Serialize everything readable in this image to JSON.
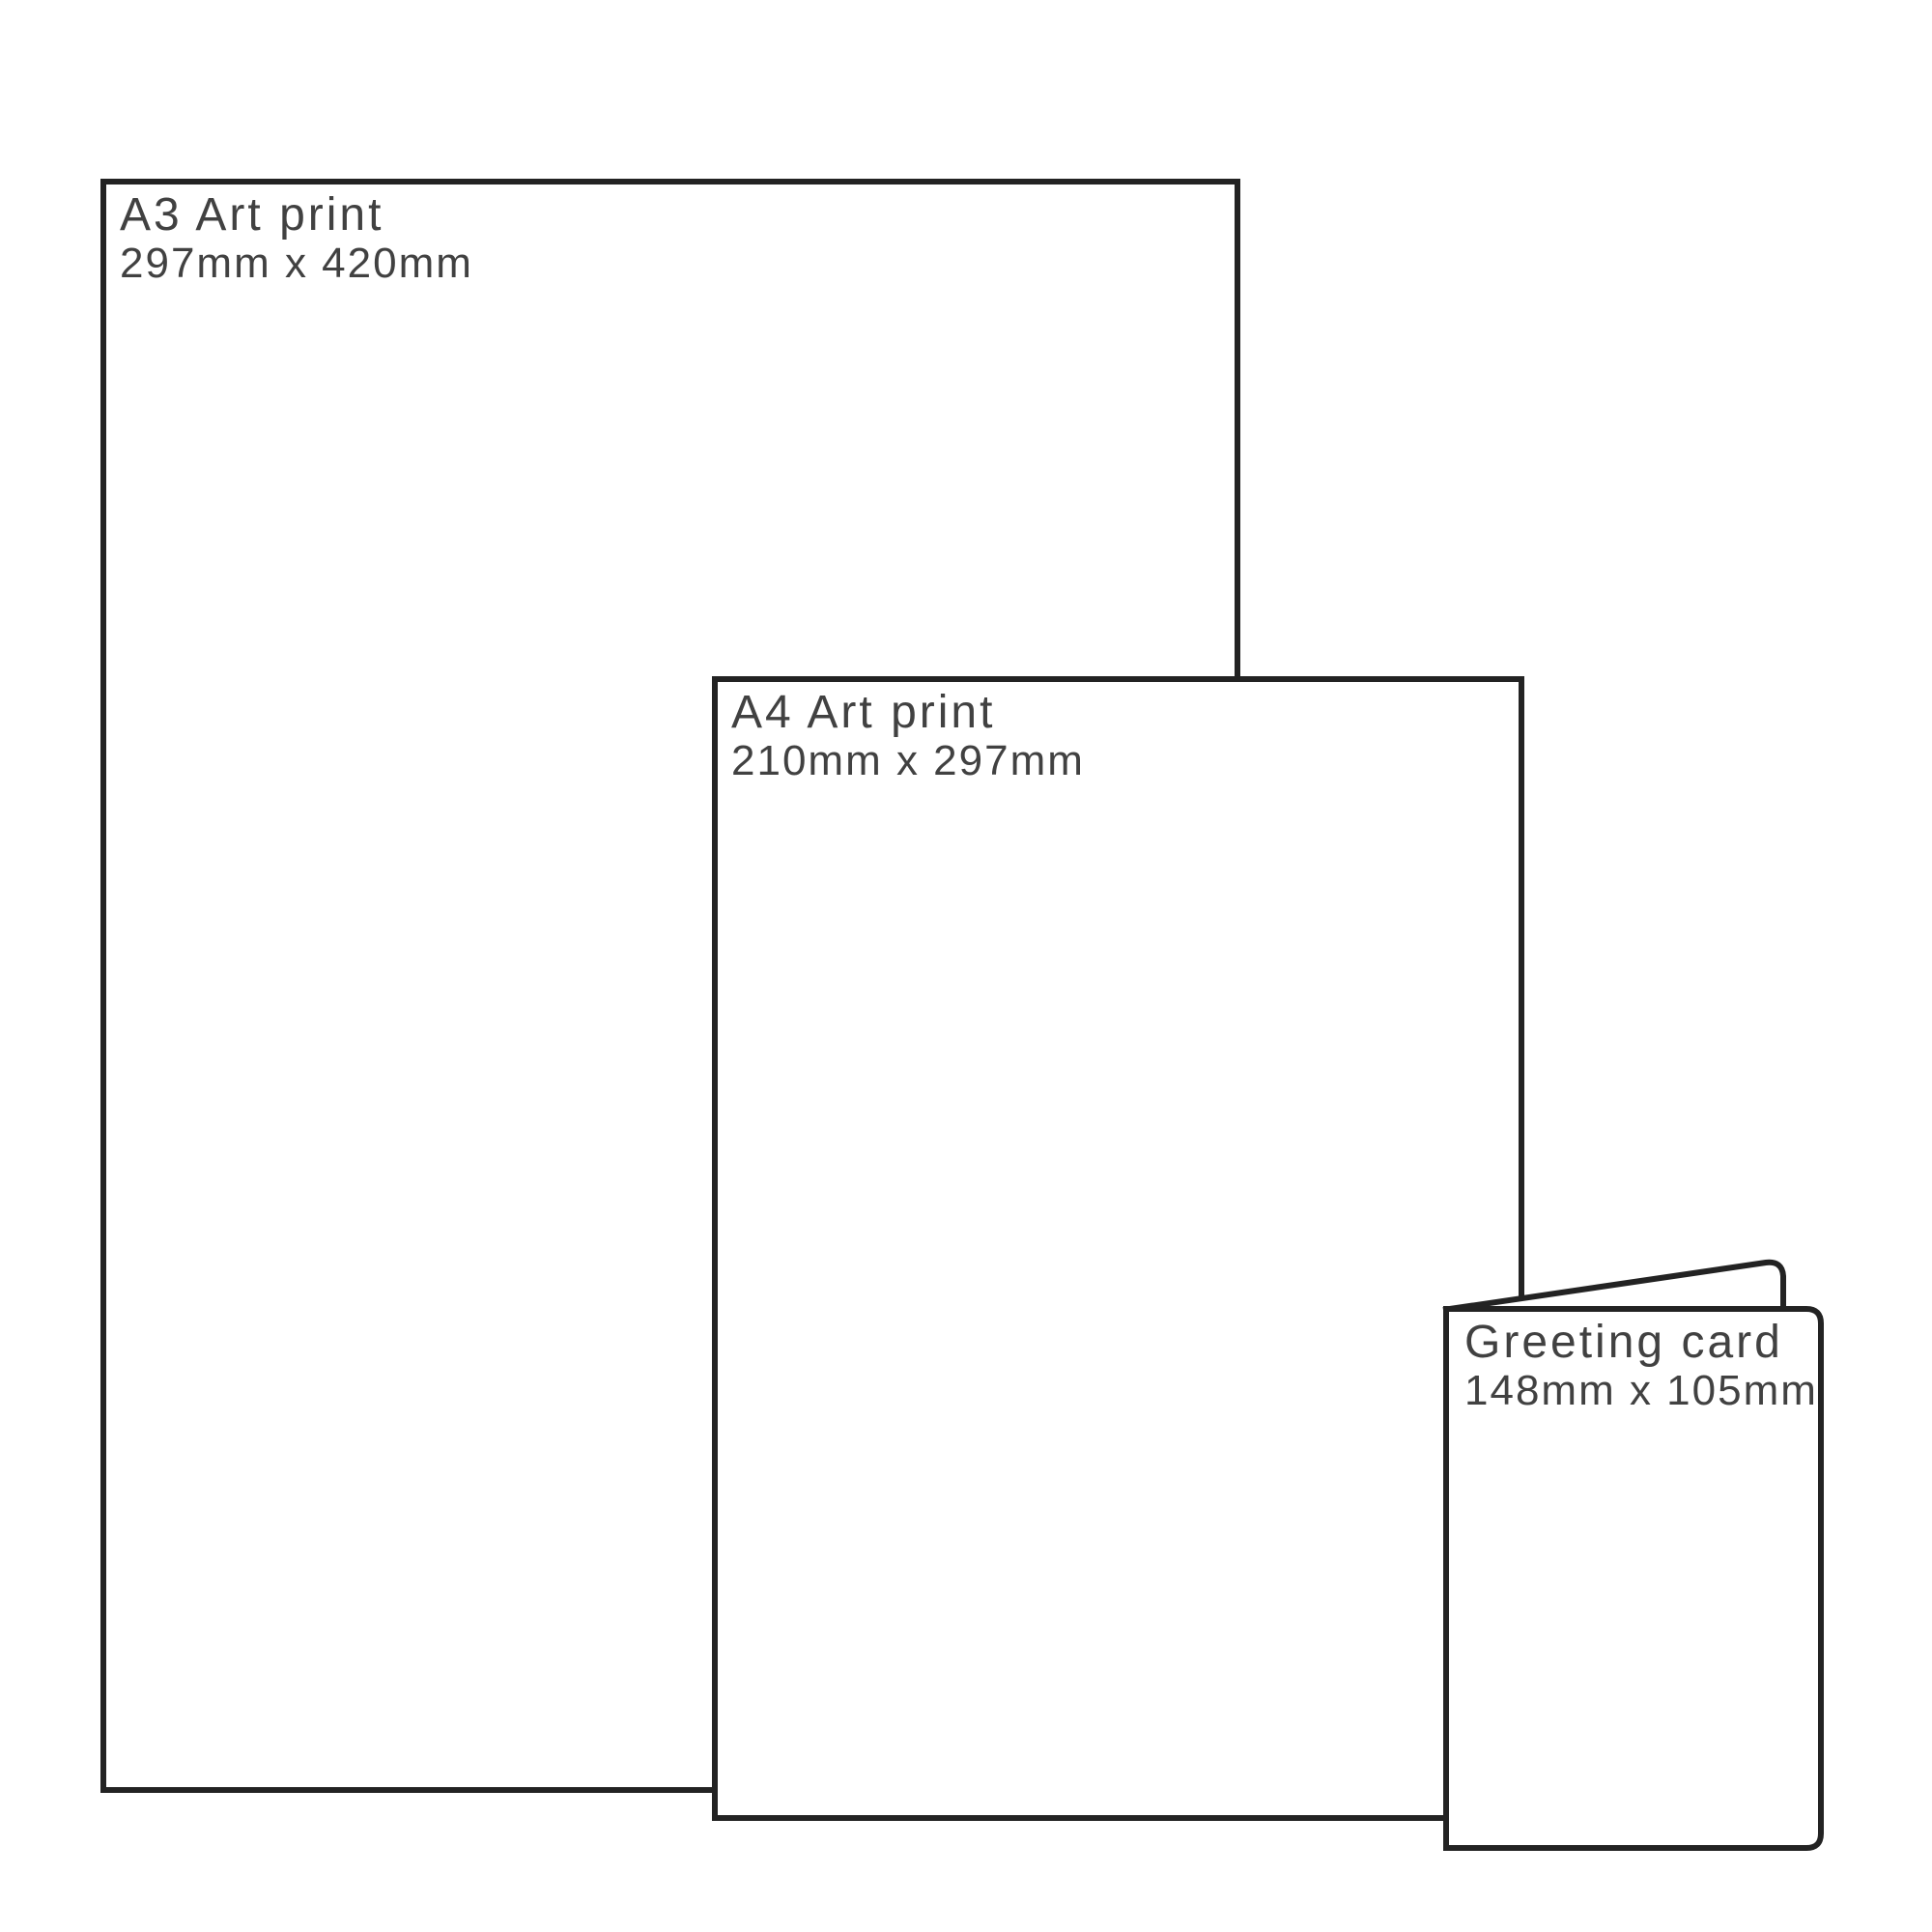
{
  "page": {
    "background_color": "#ffffff",
    "line_color": "#232323",
    "text_color": "#414141",
    "description": "Print size comparison diagram"
  },
  "items": [
    {
      "id": "a3-art-print",
      "title": "A3 Art print",
      "dimensions": "297mm x 420mm"
    },
    {
      "id": "a4-art-print",
      "title": "A4 Art print",
      "dimensions": "210mm x 297mm"
    },
    {
      "id": "greeting-card",
      "title": "Greeting card",
      "dimensions": "148mm x 105mm"
    }
  ]
}
